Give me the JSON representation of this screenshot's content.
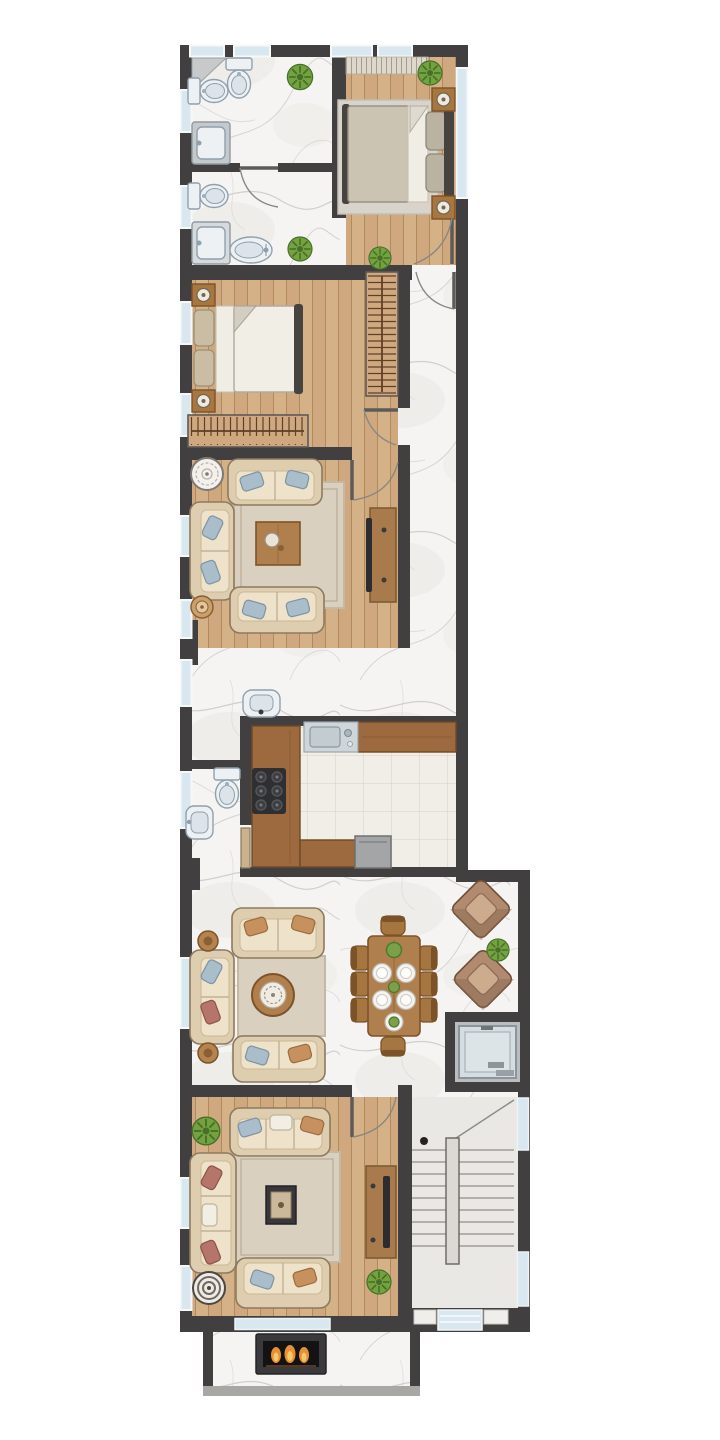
{
  "meta": {
    "type": "architectural-floor-plan",
    "style": "watercolor top-down apartment plan",
    "canvas": {
      "width": 720,
      "height": 1440
    },
    "visible_text": ""
  },
  "palette": {
    "pageBg": "#ffffff",
    "wall": "#413f40",
    "wallLight": "#5d5b59",
    "woodA": "#cfa87f",
    "woodAAlt": "#dcba90",
    "woodALine": "#b18a5c",
    "marble": "#f5f4f2",
    "marbleVein": "#c7c5c3",
    "tile": "#f1eee7",
    "tileLine": "#dbd6cd",
    "rug": "#d9d0c0",
    "rugBorder": "#c4b9a5",
    "sofa": "#eee2ca",
    "sofaShade": "#decdaf",
    "sofaLine": "#8d7a5f",
    "pillowBlue": "#a9bdcb",
    "pillowTan": "#c6915e",
    "pillowRust": "#b5756b",
    "pillowWhite": "#f2eee3",
    "bedDuvet": "#cbc4b3",
    "bedSheet": "#f0ede5",
    "bedPillow": "#bab3a2",
    "bedFrame": "#474440",
    "bed2Duvet": "#f1eee6",
    "bed2Pillow": "#cabda4",
    "furnWood": "#a8763f",
    "furnWoodDark": "#7c5328",
    "tableWood": "#b07f4e",
    "consoleWood": "#a97a4b",
    "tv": "#2d2c2e",
    "fixture": "#eef1f4",
    "fixtureShade": "#dde4e9",
    "fixtureLine": "#8fa0ad",
    "steel": "#cfd6da",
    "steelDark": "#9aa6ad",
    "plant": "#74a23f",
    "plantDark": "#46702a",
    "glass": "#d9e7f1",
    "stairFloor": "#eae8e5",
    "stairLine": "#908d89",
    "stairDivider": "#dcd9d5",
    "elevInner": "#d3dde2",
    "elevFrame": "#8e9499",
    "doorArc": "#8a8783",
    "shadow": "#8a8884",
    "flame1": "#e79035",
    "flame2": "#f7c869",
    "fireBox": "#141314",
    "fireFrame": "#3a393b",
    "curtain": "#ded7cb",
    "curtainLine": "#a49c8e",
    "counterDark": "#9c6a3e",
    "applGray": "#a3a5a6",
    "cooktop": "#2f2e30",
    "burner": "#55565a",
    "parapet": "#a9a7a4"
  },
  "rooms": [
    {
      "id": "bathroom-top",
      "furniture": [
        "toilet",
        "toilet",
        "shower-tray",
        "corner-shelf",
        "plant"
      ]
    },
    {
      "id": "bathroom-second",
      "furniture": [
        "toilet",
        "washbasin",
        "oval-bidet",
        "door",
        "plant"
      ]
    },
    {
      "id": "bedroom-master",
      "furniture": [
        "double-bed",
        "nightstand",
        "nightstand",
        "rug",
        "curtain-strip",
        "plant",
        "plant",
        "door"
      ]
    },
    {
      "id": "bedroom-second",
      "furniture": [
        "double-bed",
        "nightstand",
        "nightstand",
        "wardrobe-hangers-horizontal",
        "wardrobe-hangers-vertical",
        "door"
      ]
    },
    {
      "id": "hallway-corridor",
      "furniture": [
        "marble-floor",
        "door",
        "door"
      ]
    },
    {
      "id": "living-room-upper",
      "furniture": [
        "sofa",
        "sofa",
        "sofa",
        "coffee-table",
        "ornate-side-table",
        "round-stool",
        "tv-console",
        "tv",
        "rug",
        "door"
      ]
    },
    {
      "id": "powder-room",
      "furniture": [
        "wall-washbasin",
        "toilet",
        "washbasin"
      ]
    },
    {
      "id": "kitchen",
      "furniture": [
        "u-counter",
        "sink",
        "cooktop-6-burner",
        "appliance",
        "door-slab"
      ]
    },
    {
      "id": "family-lounge",
      "furniture": [
        "sofa",
        "sofa",
        "sofa",
        "round-coffee-table",
        "side-table",
        "side-table",
        "rug"
      ]
    },
    {
      "id": "dining-area",
      "furniture": [
        "dining-table",
        "chair",
        "chair",
        "chair",
        "chair",
        "chair",
        "chair",
        "chair",
        "chair",
        "plate",
        "plate",
        "plate",
        "plate",
        "centerpiece",
        "centerpiece",
        "centerpiece"
      ]
    },
    {
      "id": "reading-corner",
      "furniture": [
        "armchair-diamond",
        "armchair-diamond",
        "plant"
      ]
    },
    {
      "id": "elevator",
      "furniture": [
        "elevator-cab"
      ]
    },
    {
      "id": "living-room-lower",
      "furniture": [
        "sofa",
        "sofa",
        "sofa",
        "tray-table",
        "striped-side-table",
        "tv-console",
        "tv",
        "plant",
        "plant",
        "rug",
        "door"
      ]
    },
    {
      "id": "stairwell",
      "furniture": [
        "u-stairs",
        "divider-wall",
        "entry-door",
        "window",
        "window"
      ]
    },
    {
      "id": "terrace",
      "furniture": [
        "fireplace"
      ]
    }
  ]
}
